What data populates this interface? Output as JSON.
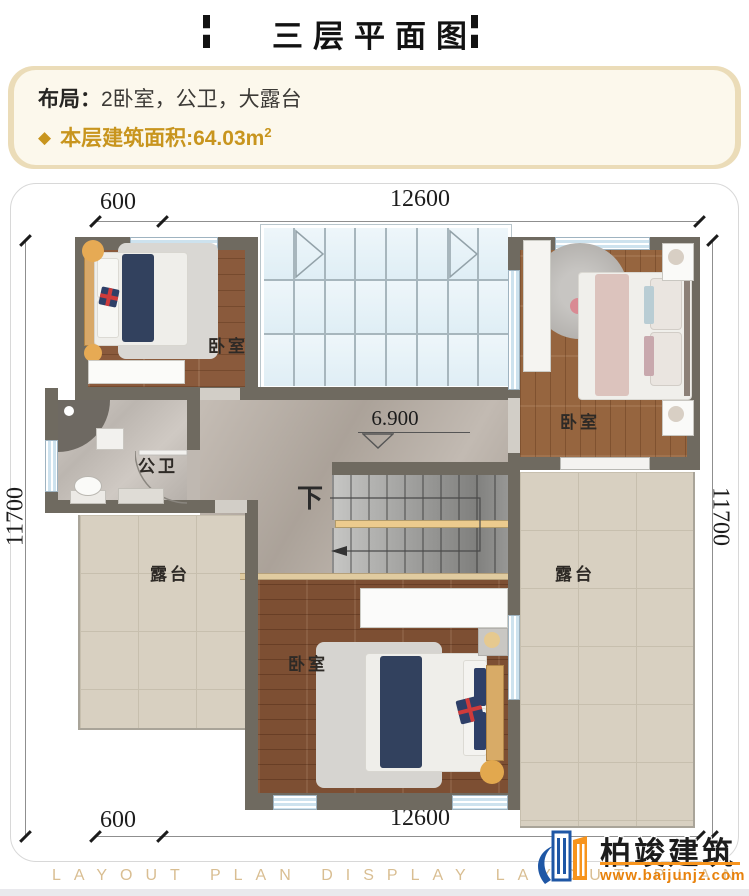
{
  "header": {
    "title": "三层平面图"
  },
  "info": {
    "layout_label": "布局：",
    "layout_value": "2卧室，公卫，大露台",
    "bullet": "◆",
    "area_label": "本层建筑面积:",
    "area_value": "64.03m",
    "area_sup": "2",
    "accent_color": "#C8951E"
  },
  "plan": {
    "dims": {
      "top_left": "600",
      "top_center": "12600",
      "bottom_left": "600",
      "bottom_center": "12600",
      "left": "11700",
      "right": "11700"
    },
    "labels": {
      "bedroom": "卧室",
      "bathroom": "公卫",
      "terrace": "露台",
      "stairs_down": "下",
      "level": "6.900"
    },
    "wall_color": "#6F6A60"
  },
  "brand": {
    "name": "柏竣建筑",
    "url": "www.baijunjz.com",
    "blue": "#1F57A5",
    "orange": "#F7941D"
  },
  "watermark": {
    "text": "LAYOUT PLAN DISPLAY LAYOUT PLAN DISPLAY"
  }
}
